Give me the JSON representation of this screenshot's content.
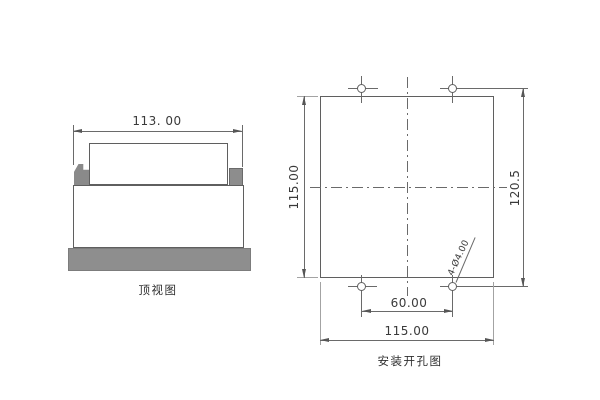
{
  "drawing": {
    "background": "#ffffff",
    "line_color": "#5f5f5f",
    "dimension_line_color": "#6a6a6a",
    "extension_line_color": "#a3a3a3",
    "fill_gray": "#8e8e8e",
    "text_color": "#3a3a3a"
  },
  "top_view": {
    "label": "顶视图",
    "width_dimension": "113. 00"
  },
  "mounting_view": {
    "label": "安装开孔图",
    "panel_height_dimension": "115.00",
    "hole_row_spacing_dimension": "120.5",
    "hole_column_spacing_dimension": "60.00",
    "panel_width_dimension": "115.00",
    "hole_callout": "4-Ø4.00"
  }
}
